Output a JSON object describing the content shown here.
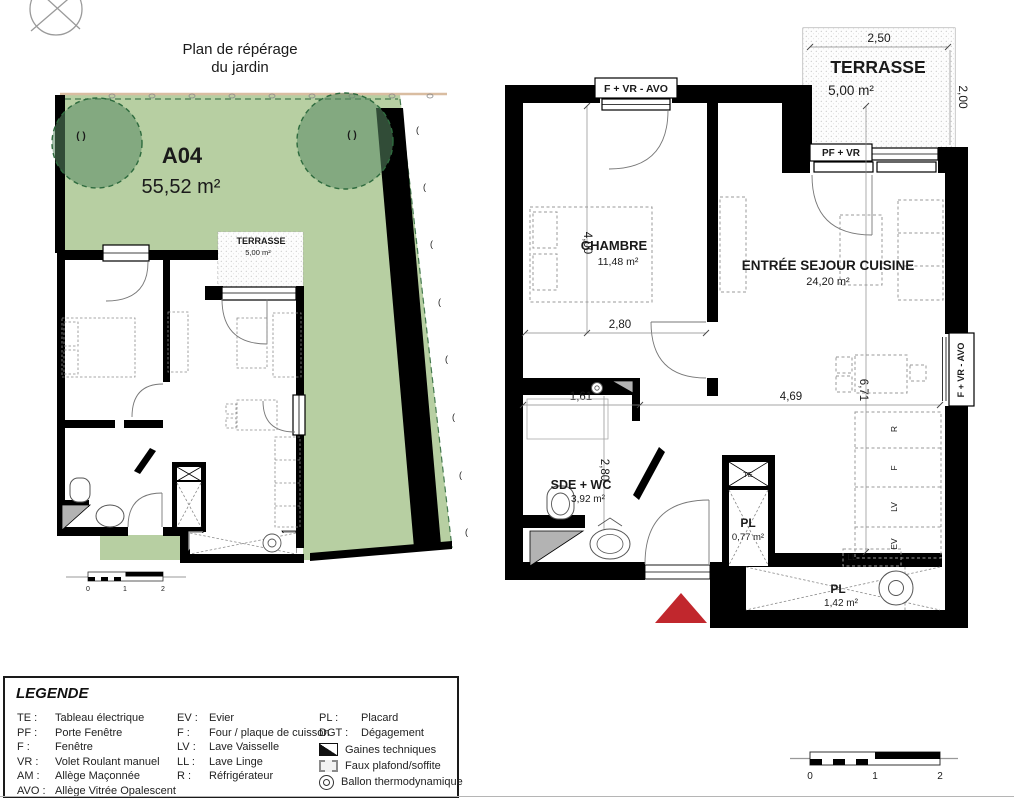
{
  "colors": {
    "garden_green": "#b7cfa2",
    "tree_green": "#6f9a78",
    "tree_border": "#2e6b3e",
    "wall_black": "#000000",
    "entrance_red": "#c1272d",
    "gaines_gray": "#b3b3b3",
    "soil_tan": "#d9bda1"
  },
  "garden_plan": {
    "title_line1": "Plan de répérage",
    "title_line2": "du jardin",
    "lot_id": "A04",
    "lot_area": "55,52 m²",
    "terrace_label": "TERRASSE",
    "terrace_area": "5,00 m²",
    "tree_mark_left": "( )",
    "tree_mark_right": "( )",
    "shrub_mark": "("
  },
  "floor_plan": {
    "terrace_label": "TERRASSE",
    "terrace_area": "5,00 m²",
    "terrace_dim_width": "2,50",
    "terrace_dim_depth": "2,00",
    "window_top_label": "F + VR - AVO",
    "window_terrace_label": "PF + VR",
    "window_right_label": "F + VR - AVO",
    "chambre_label": "CHAMBRE",
    "chambre_area": "11,48 m²",
    "chambre_dim_height": "4,00",
    "chambre_dim_width": "2,80",
    "sejour_label": "ENTRÉE SEJOUR CUISINE",
    "sejour_area": "24,20 m²",
    "sejour_dim_width": "4,69",
    "sejour_dim_height": "6,71",
    "sde_label": "SDE + WC",
    "sde_area": "3,92 m²",
    "sde_dim_width": "1,61",
    "sde_dim_height": "2,80",
    "pl1_label": "PL",
    "pl1_area": "0,77 m²",
    "pl2_label": "PL",
    "pl2_area": "1,42 m²",
    "tag_te": "TE",
    "tag_ll": "LL",
    "tag_r": "R",
    "tag_f": "F",
    "tag_lv": "LV",
    "tag_ev": "EV"
  },
  "scale_bar": {
    "t0": "0",
    "t1": "1",
    "t2": "2"
  },
  "legend": {
    "title": "LEGENDE",
    "col1": [
      {
        "abbr": "TE :",
        "label": "Tableau électrique"
      },
      {
        "abbr": "PF :",
        "label": "Porte Fenêtre"
      },
      {
        "abbr": "F :",
        "label": "Fenêtre"
      },
      {
        "abbr": "VR :",
        "label": "Volet Roulant manuel"
      },
      {
        "abbr": "AM :",
        "label": "Allège Maçonnée"
      },
      {
        "abbr": "AVO :",
        "label": "Allège Vitrée Opalescent"
      }
    ],
    "col2": [
      {
        "abbr": "EV :",
        "label": "Evier"
      },
      {
        "abbr": "F :",
        "label": "Four / plaque de cuisson"
      },
      {
        "abbr": "LV :",
        "label": "Lave Vaisselle"
      },
      {
        "abbr": "LL :",
        "label": "Lave Linge"
      },
      {
        "abbr": "R :",
        "label": "Réfrigérateur"
      }
    ],
    "col3": [
      {
        "abbr": "PL :",
        "label": "Placard"
      },
      {
        "abbr": "DGT :",
        "label": "Dégagement"
      }
    ],
    "symbols": [
      {
        "name": "gaines-techniques",
        "label": "Gaines techniques"
      },
      {
        "name": "faux-plafond",
        "label": "Faux plafond/soffite"
      },
      {
        "name": "ballon-thermo",
        "label": "Ballon thermodynamique"
      }
    ]
  }
}
